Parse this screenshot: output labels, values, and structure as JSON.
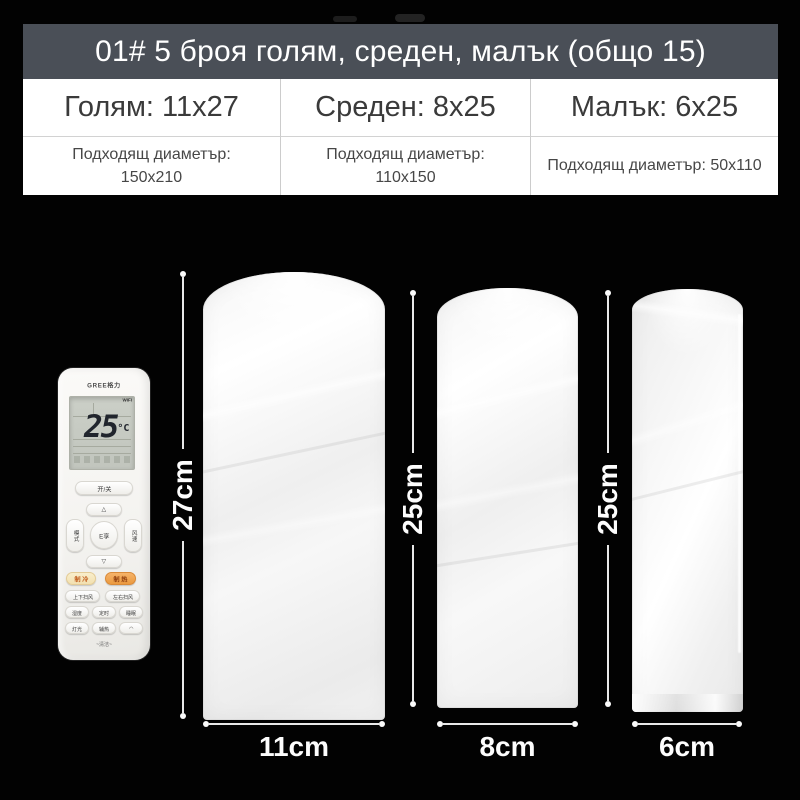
{
  "header": {
    "banner": "01# 5 броя голям, среден, малък (общо 15)",
    "columns": [
      {
        "size_label": "Голям: 11x27",
        "fit_line1": "Подходящ диаметър:",
        "fit_line2": "150x210"
      },
      {
        "size_label": "Среден: 8x25",
        "fit_line1": "Подходящ диаметър:",
        "fit_line2": "110x150"
      },
      {
        "size_label": "Малък: 6x25",
        "fit_line1": "Подходящ диаметър: 50x110",
        "fit_line2": ""
      }
    ]
  },
  "dimensions": {
    "large": {
      "height_label": "27cm",
      "width_label": "11cm"
    },
    "medium": {
      "height_label": "25cm",
      "width_label": "8cm"
    },
    "small": {
      "height_label": "25cm",
      "width_label": "6cm"
    }
  },
  "remote": {
    "brand": "GREE格力",
    "display": {
      "temperature": "25",
      "unit": "°C",
      "wifi_label": "WiFi"
    },
    "buttons": {
      "power": "开/关",
      "up": "△",
      "down": "▽",
      "mode": "模式",
      "center": "E享",
      "fan": "风速",
      "cool": "制 冷",
      "heat": "制 热",
      "swing_ud": "上下扫风",
      "swing_lr": "左右扫风",
      "humidity": "湿度",
      "timer": "定时",
      "sleep": "睡眠",
      "light": "灯光",
      "aux_heat": "辅热",
      "wifi": "◠",
      "clean": "~清洁~"
    }
  },
  "colors": {
    "background": "#020202",
    "banner_bg": "#4a4f57",
    "banner_text": "#ffffff",
    "table_bg": "#ffffff",
    "table_divider": "#cccccc",
    "dimension_line": "#e8e8e8",
    "dimension_text": "#fdfdfd",
    "cool_button": "#f2e0b0",
    "heat_button": "#eb9a40"
  }
}
